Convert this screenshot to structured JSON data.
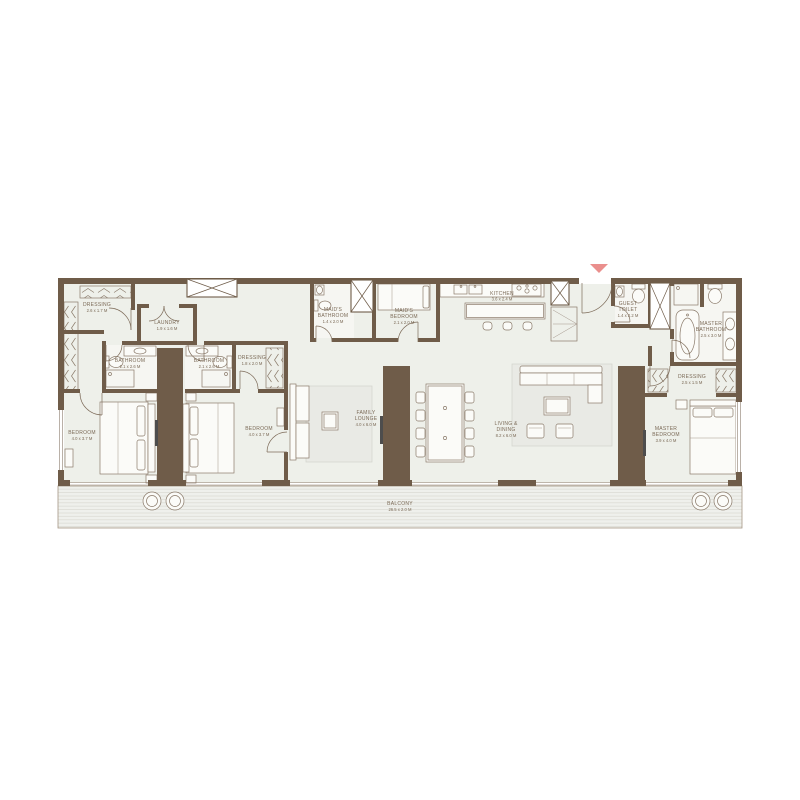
{
  "colors": {
    "wall": "#6f5c49",
    "floor": "#eef0ea",
    "fixture_stroke": "#8a7a6a",
    "rug": "#e9eae5",
    "deck_line": "#dcdcd5",
    "entry_arrow": "#ea8f8d",
    "label_text": "#7b6a57"
  },
  "rooms": {
    "dressing_nw": [
      "DRESSING",
      "2.6 x 1.7 M"
    ],
    "laundry": [
      "LAUNDRY",
      "1.9 x 1.6 M"
    ],
    "bathroom_1": [
      "BATHROOM",
      "2.1 x 2.6 M"
    ],
    "bathroom_2": [
      "BATHROOM",
      "2.1 x 2.6 M"
    ],
    "dressing_2": [
      "DRESSING",
      "1.8 x 2.0 M"
    ],
    "bedroom_1": [
      "BEDROOM",
      "4.0 x 3.7 M"
    ],
    "bedroom_2": [
      "BEDROOM",
      "4.0 x 3.7 M"
    ],
    "maids_bathroom": [
      "MAID'S",
      "BATHROOM",
      "1.4 x 2.0 M"
    ],
    "maids_bedroom": [
      "MAID'S",
      "BEDROOM",
      "2.1 x 2.0 M"
    ],
    "kitchen": [
      "KITCHEN",
      "3.6 x 2.4 M"
    ],
    "family_lounge": [
      "FAMILY",
      "LOUNGE",
      "4.0 x 6.0 M"
    ],
    "living_dining": [
      "LIVING &",
      "DINING",
      "8.2 x 6.0 M"
    ],
    "guest_toilet": [
      "GUEST",
      "TOILET",
      "1.4 x 2.2 M"
    ],
    "master_bathroom": [
      "MASTER",
      "BATHROOM",
      "2.5 x 3.0 M"
    ],
    "dressing_master": [
      "DRESSING",
      "2.5 x 1.5 M"
    ],
    "master_bedroom": [
      "MASTER",
      "BEDROOM",
      "3.9 x 4.0 M"
    ],
    "balcony": [
      "BALCONY",
      "26.5 x 2.0 M"
    ]
  }
}
